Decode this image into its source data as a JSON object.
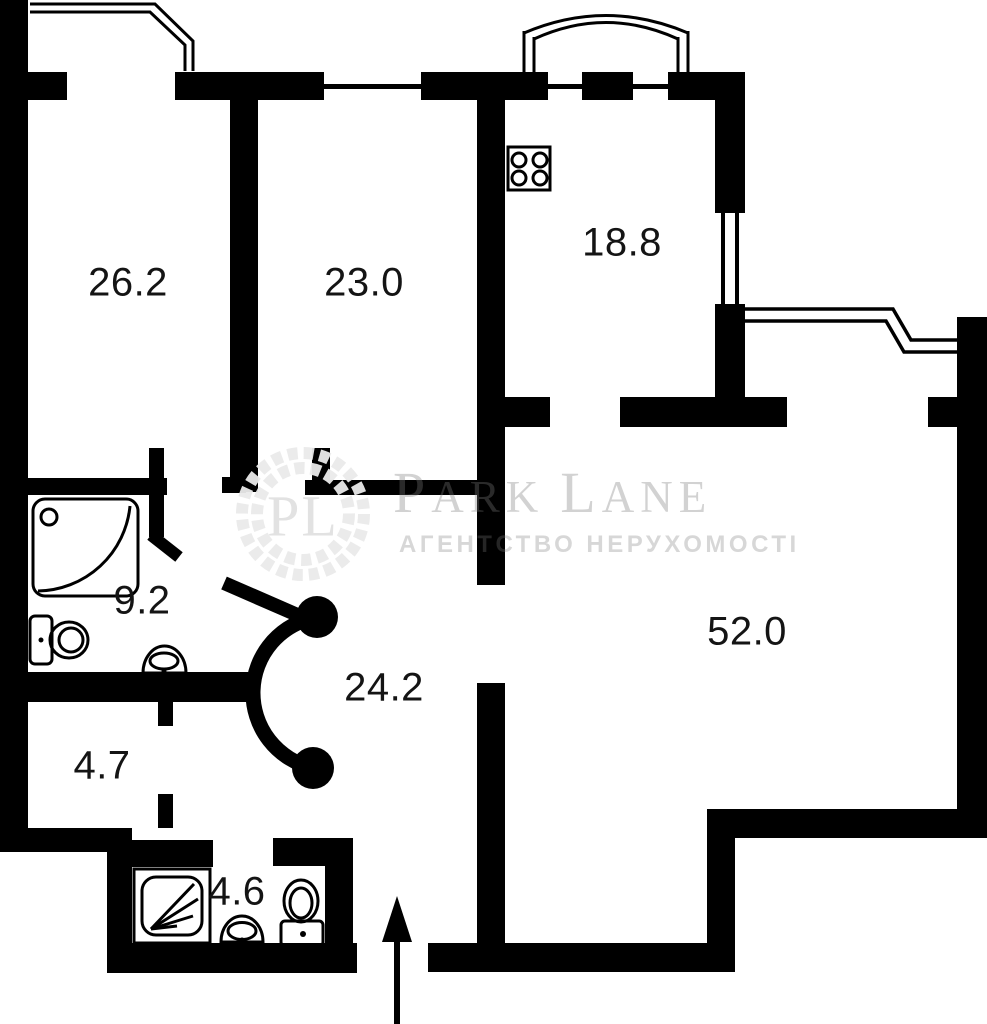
{
  "plan_title": "apartment-floor-plan",
  "colors": {
    "wall": "#000000",
    "background": "#ffffff",
    "label_text": "#141414",
    "watermark_gray": "#7a7a7a",
    "wreath_gray": "#eaeaea"
  },
  "rooms": [
    {
      "id": "room-26-2",
      "area": "26.2"
    },
    {
      "id": "room-23-0",
      "area": "23.0"
    },
    {
      "id": "kitchen-18-8",
      "area": "18.8"
    },
    {
      "id": "room-52-0",
      "area": "52.0"
    },
    {
      "id": "bathroom-9-2",
      "area": "9.2"
    },
    {
      "id": "hall-24-2",
      "area": "24.2"
    },
    {
      "id": "room-4-7",
      "area": "4.7"
    },
    {
      "id": "bathroom-4-6",
      "area": "4.6"
    }
  ],
  "watermark": {
    "monogram": "PL",
    "brand_parts": [
      "P",
      "ARK",
      "L",
      "ANE"
    ],
    "tagline": "АГЕНТСТВО НЕРУХОМОСТІ"
  },
  "fixtures": [
    "stove-icon",
    "shower-tray-icon",
    "toilet-icon",
    "sink-icon",
    "shower-cabin-icon",
    "entrance-arrow-icon",
    "door-swing-symbol",
    "window",
    "balcony-railing",
    "balcony-arch",
    "bay-window-outline"
  ]
}
